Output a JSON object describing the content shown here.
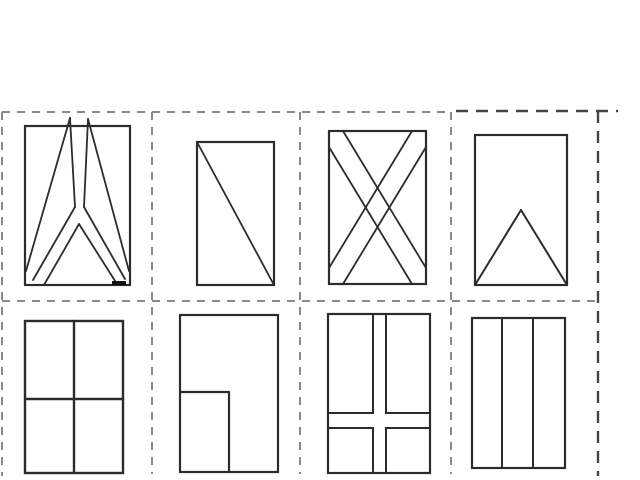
{
  "canvas": {
    "width": 640,
    "height": 480,
    "background": "#ffffff"
  },
  "colors": {
    "shape_stroke": "#2c2c2c",
    "mark_stroke": "#111111",
    "grid_light": "#8a8a8a",
    "grid_dark": "#454545"
  },
  "dash_styles": {
    "light": {
      "dash": "8 7",
      "width": 2
    },
    "dark": {
      "dash": "12 8",
      "width": 2.4
    }
  },
  "cut_guides": [
    {
      "name": "cut-line-top-main",
      "x1": 2,
      "y1": 112,
      "x2": 448,
      "y2": 112,
      "style": "light"
    },
    {
      "name": "cut-line-top-card4",
      "x1": 456,
      "y1": 111,
      "x2": 618,
      "y2": 111,
      "style": "dark"
    },
    {
      "name": "cut-line-middle",
      "x1": 2,
      "y1": 301,
      "x2": 598,
      "y2": 301,
      "style": "light"
    },
    {
      "name": "cut-line-left",
      "x1": 2,
      "y1": 112,
      "x2": 2,
      "y2": 476,
      "style": "light"
    },
    {
      "name": "cut-line-divider-1",
      "x1": 152,
      "y1": 112,
      "x2": 152,
      "y2": 474,
      "style": "light"
    },
    {
      "name": "cut-line-divider-2",
      "x1": 300,
      "y1": 112,
      "x2": 300,
      "y2": 474,
      "style": "light"
    },
    {
      "name": "cut-line-divider-3",
      "x1": 451,
      "y1": 112,
      "x2": 451,
      "y2": 474,
      "style": "light"
    },
    {
      "name": "cut-line-right-card4",
      "x1": 598,
      "y1": 111,
      "x2": 598,
      "y2": 476,
      "style": "dark"
    }
  ],
  "cards": [
    {
      "name": "flag-card-split-y",
      "rect": [
        25,
        126,
        105,
        159
      ],
      "rect_stroke": 2.2,
      "line_stroke": 1.8,
      "lines": [
        [
          70,
          118,
          26,
          271
        ],
        [
          70,
          118,
          75,
          207
        ],
        [
          88,
          119,
          84,
          207
        ],
        [
          88,
          119,
          129,
          271
        ],
        [
          75,
          207,
          33,
          280
        ],
        [
          84,
          207,
          125,
          279
        ],
        [
          79,
          224,
          44,
          285
        ],
        [
          79,
          224,
          117,
          284
        ]
      ],
      "thick_marks": [
        [
          112,
          283,
          126,
          283
        ]
      ]
    },
    {
      "name": "flag-card-diagonal",
      "rect": [
        197,
        142,
        77,
        143
      ],
      "rect_stroke": 2.2,
      "line_stroke": 1.8,
      "lines": [
        [
          197,
          142,
          274,
          285
        ]
      ],
      "thick_marks": []
    },
    {
      "name": "flag-card-saltire",
      "rect": [
        329,
        131,
        97,
        153
      ],
      "rect_stroke": 2.2,
      "line_stroke": 1.8,
      "lines": [
        [
          343,
          131,
          426,
          268
        ],
        [
          329,
          147,
          412,
          284
        ],
        [
          412,
          131,
          329,
          268
        ],
        [
          426,
          147,
          343,
          284
        ]
      ],
      "thick_marks": []
    },
    {
      "name": "flag-card-triangle",
      "rect": [
        475,
        135,
        92,
        150
      ],
      "rect_stroke": 2.2,
      "line_stroke": 2,
      "lines": [
        [
          521,
          210,
          475,
          285
        ],
        [
          521,
          210,
          567,
          285
        ]
      ],
      "thick_marks": []
    },
    {
      "name": "flag-card-quadrants",
      "rect": [
        25,
        321,
        98,
        152
      ],
      "rect_stroke": 2.4,
      "line_stroke": 2.4,
      "lines": [
        [
          74,
          321,
          74,
          473
        ],
        [
          25,
          399,
          123,
          399
        ]
      ],
      "thick_marks": []
    },
    {
      "name": "flag-card-corner-box",
      "rect": [
        180,
        315,
        98,
        157
      ],
      "rect_stroke": 2.2,
      "line_stroke": 2.2,
      "lines": [
        [
          180,
          392,
          229,
          392
        ],
        [
          229,
          392,
          229,
          472
        ]
      ],
      "thick_marks": []
    },
    {
      "name": "flag-card-nordic-cross",
      "rect": [
        328,
        314,
        102,
        159
      ],
      "rect_stroke": 2.2,
      "line_stroke": 2,
      "lines": [],
      "inner_rects": [
        [
          328,
          314,
          45,
          99
        ],
        [
          386,
          314,
          44,
          99
        ],
        [
          328,
          428,
          45,
          45
        ],
        [
          386,
          428,
          44,
          45
        ]
      ],
      "thick_marks": []
    },
    {
      "name": "flag-card-three-stripes",
      "rect": [
        472,
        318,
        93,
        150
      ],
      "rect_stroke": 2.2,
      "line_stroke": 2,
      "lines": [
        [
          502,
          318,
          502,
          468
        ],
        [
          533,
          318,
          533,
          468
        ]
      ],
      "thick_marks": []
    }
  ]
}
